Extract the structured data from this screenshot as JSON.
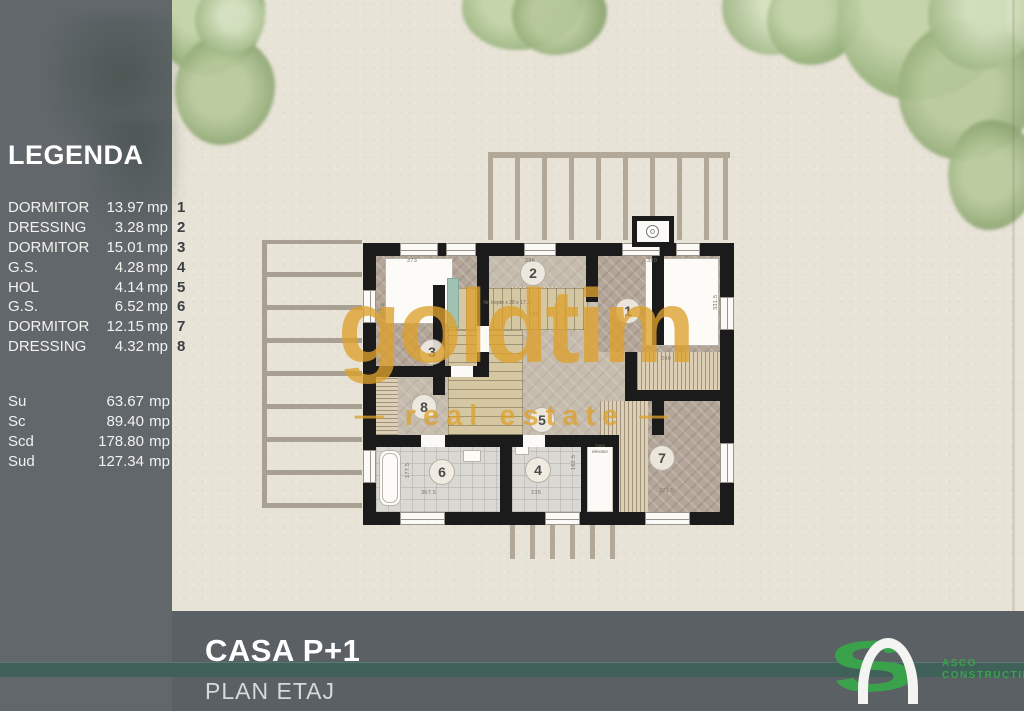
{
  "legend": {
    "title": "LEGENDA",
    "rows": [
      {
        "label": "DORMITOR",
        "area": "13.97",
        "unit": "mp",
        "num": "1"
      },
      {
        "label": "DRESSING",
        "area": "3.28",
        "unit": "mp",
        "num": "2"
      },
      {
        "label": "DORMITOR",
        "area": "15.01",
        "unit": "mp",
        "num": "3"
      },
      {
        "label": "G.S.",
        "area": "4.28",
        "unit": "mp",
        "num": "4"
      },
      {
        "label": "HOL",
        "area": "4.14",
        "unit": "mp",
        "num": "5"
      },
      {
        "label": "G.S.",
        "area": "6.52",
        "unit": "mp",
        "num": "6"
      },
      {
        "label": "DORMITOR",
        "area": "12.15",
        "unit": "mp",
        "num": "7"
      },
      {
        "label": "DRESSING",
        "area": "4.32",
        "unit": "mp",
        "num": "8"
      }
    ],
    "totals": [
      {
        "label": "Su",
        "value": "63.67",
        "unit": "mp"
      },
      {
        "label": "Sc",
        "value": "89.40",
        "unit": "mp"
      },
      {
        "label": "Scd",
        "value": "178.80",
        "unit": "mp"
      },
      {
        "label": "Sud",
        "value": "127.34",
        "unit": "mp"
      }
    ]
  },
  "watermark": {
    "word": "goldtim",
    "dash_left": "—",
    "tagline": "real estate",
    "dash_right": "—"
  },
  "footer": {
    "title": "CASA P+1",
    "subtitle": "PLAN ETAJ",
    "logo_s": "S",
    "logo_line1": "ASCO",
    "logo_line2": "CONSTRUCTII"
  },
  "plan": {
    "rooms": [
      {
        "num": "1"
      },
      {
        "num": "2"
      },
      {
        "num": "3"
      },
      {
        "num": "4"
      },
      {
        "num": "5"
      },
      {
        "num": "6"
      },
      {
        "num": "7"
      },
      {
        "num": "8"
      }
    ],
    "dims": {
      "top_left": "373",
      "top_mid": "296",
      "top_right": "380",
      "bottom_left": "367.5",
      "bottom_mid": "235",
      "bottom_right": "371.5",
      "left_side": "236.5",
      "right_side": "331.5",
      "room6_side": "177.5",
      "room4_side": "162.5",
      "wardrobe": "240",
      "stair_mid": "195"
    },
    "stair_note": "Nr. trepte x 28 x 17.71",
    "elevator_note": "mast elevator"
  },
  "colors": {
    "accent_gold": "#DCA02C",
    "teal_stripe": "#40615A",
    "logo_green": "#3BA24C",
    "sidebar_gray": "#61676B",
    "footer_gray": "#5A6064",
    "wall_black": "#1B1B1B",
    "paper": "#E8E3D7"
  }
}
